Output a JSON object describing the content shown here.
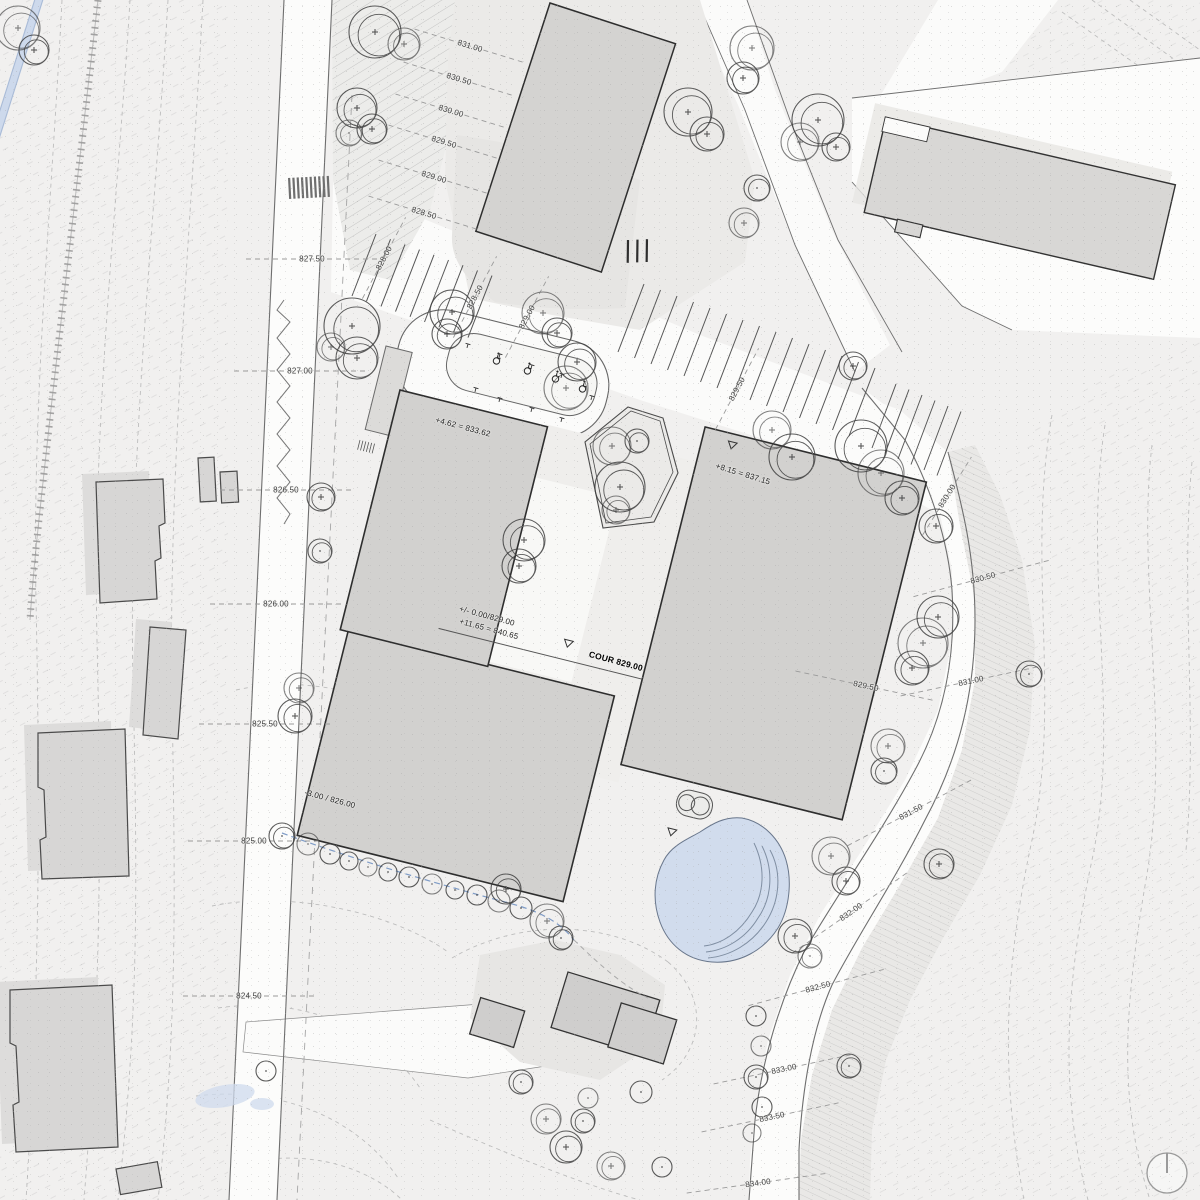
{
  "drawing": {
    "courtyard_label": "COUR 829.00",
    "colors": {
      "background": "#f1f0ef",
      "road_white": "#fbfbfa",
      "building_fill": "#d2d1cf",
      "building_outline": "#2e2e2e",
      "existing_building_fill": "#d7d6d5",
      "pond_blue": "#ccd9ed",
      "stream_blue": "#cdd9ec",
      "contour_line": "#bdbdbd",
      "label_text": "#3f3f3f"
    }
  },
  "elevations": {
    "left_road": [
      {
        "t": "827.50",
        "x": 312,
        "y": 259,
        "r": 0
      },
      {
        "t": "827.00",
        "x": 300,
        "y": 371,
        "r": 0
      },
      {
        "t": "826.50",
        "x": 286,
        "y": 490,
        "r": 0
      },
      {
        "t": "826.00",
        "x": 276,
        "y": 604,
        "r": 0
      },
      {
        "t": "825.50",
        "x": 265,
        "y": 724,
        "r": 0
      },
      {
        "t": "825.00",
        "x": 254,
        "y": 841,
        "r": 0
      },
      {
        "t": "824.50",
        "x": 249,
        "y": 996,
        "r": 0
      }
    ],
    "upper_slope": [
      {
        "t": "831.00",
        "x": 470,
        "y": 46,
        "r": 17
      },
      {
        "t": "830.50",
        "x": 459,
        "y": 79,
        "r": 17
      },
      {
        "t": "830.00",
        "x": 451,
        "y": 111,
        "r": 17
      },
      {
        "t": "829.50",
        "x": 444,
        "y": 142,
        "r": 17
      },
      {
        "t": "829.00",
        "x": 434,
        "y": 177,
        "r": 17
      },
      {
        "t": "828.50",
        "x": 424,
        "y": 213,
        "r": 17
      }
    ],
    "parking": [
      {
        "t": "828.00",
        "x": 384,
        "y": 258,
        "r": -62
      },
      {
        "t": "828.50",
        "x": 475,
        "y": 297,
        "r": -62
      },
      {
        "t": "829.00",
        "x": 527,
        "y": 317,
        "r": -62
      },
      {
        "t": "829.50",
        "x": 737,
        "y": 389,
        "r": -62
      },
      {
        "t": "830.00",
        "x": 947,
        "y": 496,
        "r": -58
      }
    ],
    "right_road": [
      {
        "t": "829.50",
        "x": 866,
        "y": 686,
        "r": 12
      },
      {
        "t": "830.50",
        "x": 983,
        "y": 578,
        "r": -15
      },
      {
        "t": "831.00",
        "x": 971,
        "y": 681,
        "r": -12
      },
      {
        "t": "831.50",
        "x": 911,
        "y": 812,
        "r": -28
      },
      {
        "t": "832.00",
        "x": 851,
        "y": 912,
        "r": -35
      },
      {
        "t": "832.50",
        "x": 818,
        "y": 987,
        "r": -15
      },
      {
        "t": "833.00",
        "x": 784,
        "y": 1069,
        "r": -12
      },
      {
        "t": "833.50",
        "x": 772,
        "y": 1117,
        "r": -12
      },
      {
        "t": "834.00",
        "x": 758,
        "y": 1183,
        "r": -8
      }
    ]
  },
  "building_annotations": [
    {
      "t": "+4.62 = 833.62",
      "x": 463,
      "y": 427,
      "r": 15
    },
    {
      "t": "+/- 0.00/829.00",
      "x": 487,
      "y": 616,
      "r": 15
    },
    {
      "t": "+11.65 = 840.65",
      "x": 489,
      "y": 629,
      "r": 15
    },
    {
      "t": "COUR 829.00",
      "x": 616,
      "y": 661,
      "r": 15,
      "b": 1
    },
    {
      "t": "-3.00 / 826.00",
      "x": 330,
      "y": 799,
      "r": 15
    },
    {
      "t": "+8.15 = 837.15",
      "x": 743,
      "y": 474,
      "r": 17
    }
  ],
  "symbols": {
    "north_marker": "circle-with-tick",
    "accessible_parking_spaces": 4,
    "crosswalk_stripes": 10
  },
  "trees": [
    [
      18,
      28,
      22
    ],
    [
      34,
      50,
      15
    ],
    [
      375,
      32,
      26
    ],
    [
      404,
      44,
      16
    ],
    [
      357,
      108,
      20
    ],
    [
      372,
      129,
      15
    ],
    [
      349,
      133,
      13
    ],
    [
      688,
      112,
      24
    ],
    [
      707,
      134,
      17
    ],
    [
      752,
      48,
      22
    ],
    [
      743,
      78,
      16
    ],
    [
      818,
      120,
      26
    ],
    [
      800,
      142,
      19
    ],
    [
      836,
      147,
      14
    ],
    [
      757,
      188,
      13
    ],
    [
      744,
      223,
      15
    ],
    [
      352,
      326,
      28
    ],
    [
      357,
      358,
      21
    ],
    [
      331,
      347,
      14
    ],
    [
      452,
      312,
      22
    ],
    [
      447,
      334,
      15
    ],
    [
      543,
      313,
      21
    ],
    [
      557,
      333,
      15
    ],
    [
      577,
      362,
      19
    ],
    [
      566,
      388,
      22
    ],
    [
      853,
      366,
      14
    ],
    [
      861,
      446,
      26
    ],
    [
      881,
      473,
      23
    ],
    [
      902,
      498,
      17
    ],
    [
      936,
      526,
      17
    ],
    [
      612,
      446,
      19
    ],
    [
      637,
      441,
      12
    ],
    [
      620,
      487,
      25
    ],
    [
      616,
      510,
      14
    ],
    [
      524,
      540,
      21
    ],
    [
      519,
      566,
      17
    ],
    [
      772,
      430,
      19
    ],
    [
      792,
      457,
      23
    ],
    [
      938,
      617,
      21
    ],
    [
      923,
      643,
      25
    ],
    [
      912,
      668,
      17
    ],
    [
      1029,
      674,
      13
    ],
    [
      888,
      746,
      17
    ],
    [
      884,
      771,
      13
    ],
    [
      939,
      864,
      15
    ],
    [
      831,
      856,
      19
    ],
    [
      846,
      881,
      14
    ],
    [
      795,
      936,
      17
    ],
    [
      810,
      956,
      12
    ],
    [
      321,
      497,
      14
    ],
    [
      320,
      551,
      12
    ],
    [
      299,
      688,
      15
    ],
    [
      295,
      716,
      17
    ],
    [
      282,
      836,
      13
    ],
    [
      308,
      844,
      11
    ],
    [
      330,
      854,
      10
    ],
    [
      349,
      861,
      9
    ],
    [
      368,
      867,
      9
    ],
    [
      388,
      872,
      9
    ],
    [
      409,
      877,
      10
    ],
    [
      432,
      884,
      10
    ],
    [
      455,
      890,
      9
    ],
    [
      477,
      895,
      10
    ],
    [
      499,
      901,
      11
    ],
    [
      521,
      908,
      11
    ],
    [
      506,
      889,
      15
    ],
    [
      547,
      921,
      17
    ],
    [
      561,
      938,
      12
    ],
    [
      756,
      1016,
      10
    ],
    [
      761,
      1046,
      10
    ],
    [
      756,
      1077,
      12
    ],
    [
      762,
      1107,
      10
    ],
    [
      752,
      1133,
      9
    ],
    [
      849,
      1066,
      12
    ],
    [
      521,
      1082,
      12
    ],
    [
      546,
      1119,
      15
    ],
    [
      566,
      1147,
      16
    ],
    [
      583,
      1121,
      12
    ],
    [
      611,
      1166,
      14
    ],
    [
      641,
      1092,
      11
    ],
    [
      662,
      1167,
      10
    ],
    [
      588,
      1098,
      10
    ],
    [
      266,
      1071,
      10
    ]
  ]
}
